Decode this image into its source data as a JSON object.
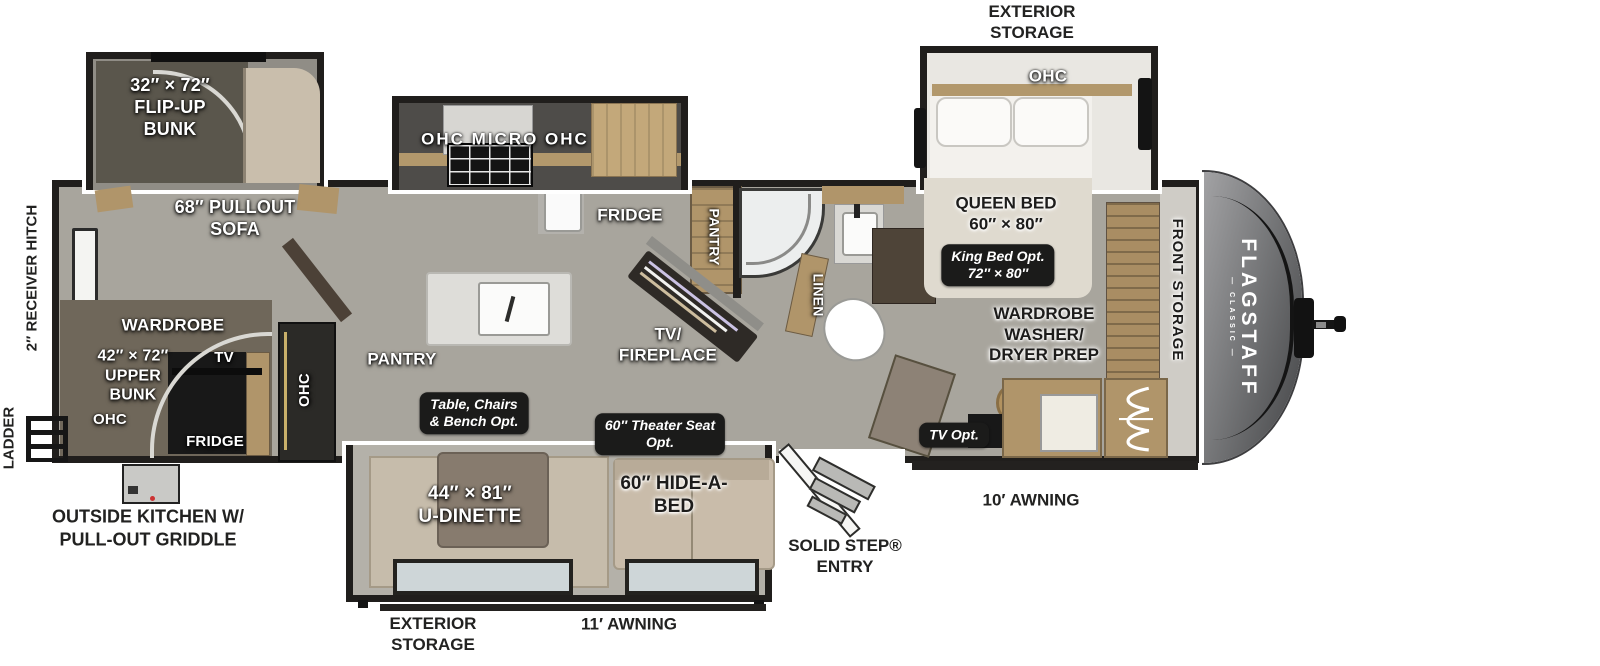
{
  "colors": {
    "wall": "#201e1c",
    "floor": "#a8a59d",
    "wood": "#b0956a",
    "tan_cushion": "#c9bcaa",
    "label_box": "#1b1b1a",
    "front_cap": "#6f7072"
  },
  "left": {
    "ladder_label": "LADDER",
    "receiver_hitch": "2″ RECEIVER HITCH",
    "outside_kitchen": "OUTSIDE KITCHEN W/\nPULL-OUT GRIDDLE"
  },
  "rear_room": {
    "flip_up_bunk": "32″ × 72″\nFLIP-UP\nBUNK",
    "pullout_sofa": "68″ PULLOUT\nSOFA",
    "wardrobe": "WARDROBE",
    "upper_bunk": "42″ × 72″\nUPPER\nBUNK",
    "ohc_small": "OHC",
    "tv": "TV",
    "fridge": "FRIDGE",
    "ohc_column": "OHC"
  },
  "kitchen": {
    "ohc_micro_ohc": "OHC MICRO OHC",
    "fridge": "FRIDGE",
    "pantry": "PANTRY",
    "tv_fireplace": "TV/\nFIREPLACE"
  },
  "bath": {
    "pantry": "PANTRY",
    "linen": "LINEN"
  },
  "bedroom": {
    "exterior_storage": "EXTERIOR\nSTORAGE",
    "ohc": "OHC",
    "queen_bed": "QUEEN BED\n60″ × 80″",
    "king_opt": "King Bed Opt.\n72″ × 80″",
    "wardrobe_washer": "WARDROBE\nWASHER/\nDRYER PREP",
    "tv_opt": "TV Opt.",
    "front_storage": "FRONT STORAGE"
  },
  "front_cap": {
    "brand": "FLAGSTAFF",
    "series": "— CLASSIC —"
  },
  "bottom": {
    "exterior_storage": "EXTERIOR\nSTORAGE",
    "awning_11": "11′ AWNING",
    "awning_10": "10′ AWNING",
    "solid_step": "SOLID STEP®\nENTRY",
    "table_opt": "Table, Chairs\n& Bench  Opt.",
    "u_dinette": "44″ × 81″\nU-DINETTE",
    "theater_opt": "60″ Theater Seat\nOpt.",
    "hide_a_bed": "60″ HIDE-A-\nBED"
  }
}
